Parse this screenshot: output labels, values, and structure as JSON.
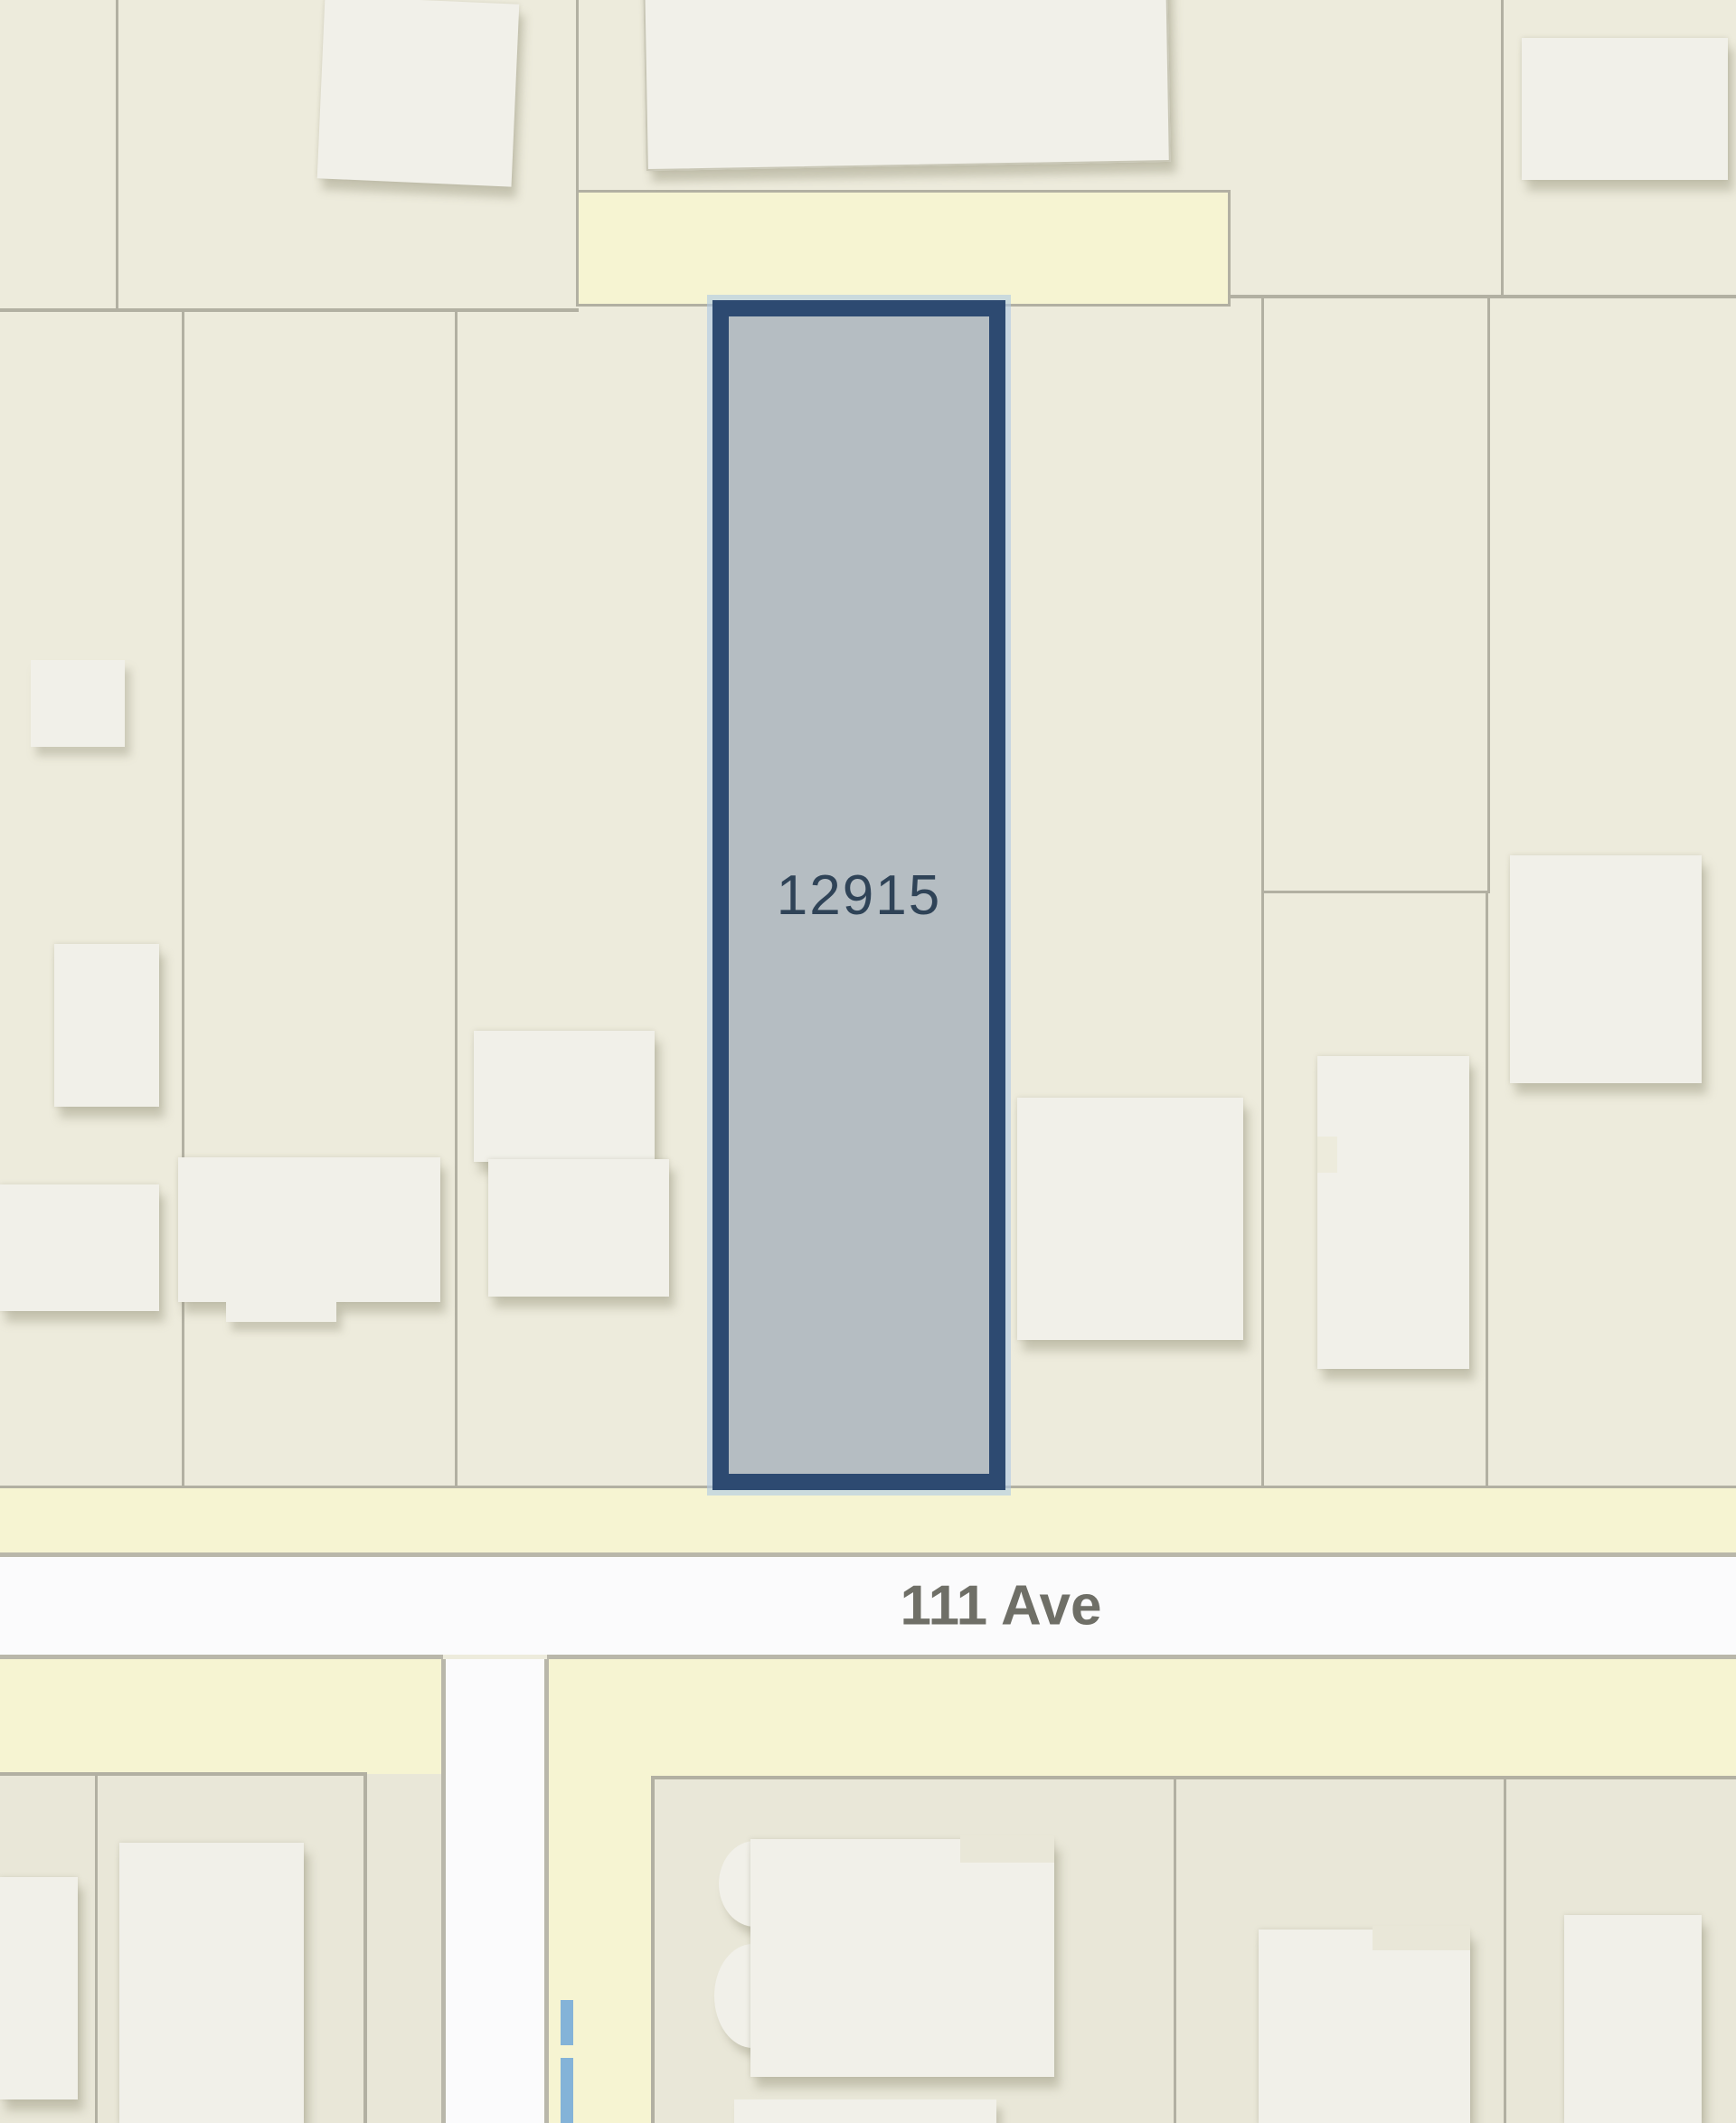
{
  "map": {
    "selected_parcel": {
      "label": "12915"
    },
    "street": {
      "label": "111 Ave"
    }
  },
  "colors": {
    "bg-cream": "#edebdc",
    "bg-cream-dark": "#e9e7d8",
    "road-yellow": "#f6f4d2",
    "road-white": "#fbfbfc",
    "road-edge": "#b9b7aa",
    "parcel-line": "#b2b0a2",
    "building-fill": "#f1f0e9",
    "building-edge": "#c9c7b6",
    "selected-border": "#2d4a71",
    "selected-fill": "#b5bdc2",
    "selected-halo": "rgba(173,200,228,0.6)",
    "lot-label": "#2f4357",
    "street-label": "#6f6f67",
    "water-blue": "#84b3d8"
  }
}
